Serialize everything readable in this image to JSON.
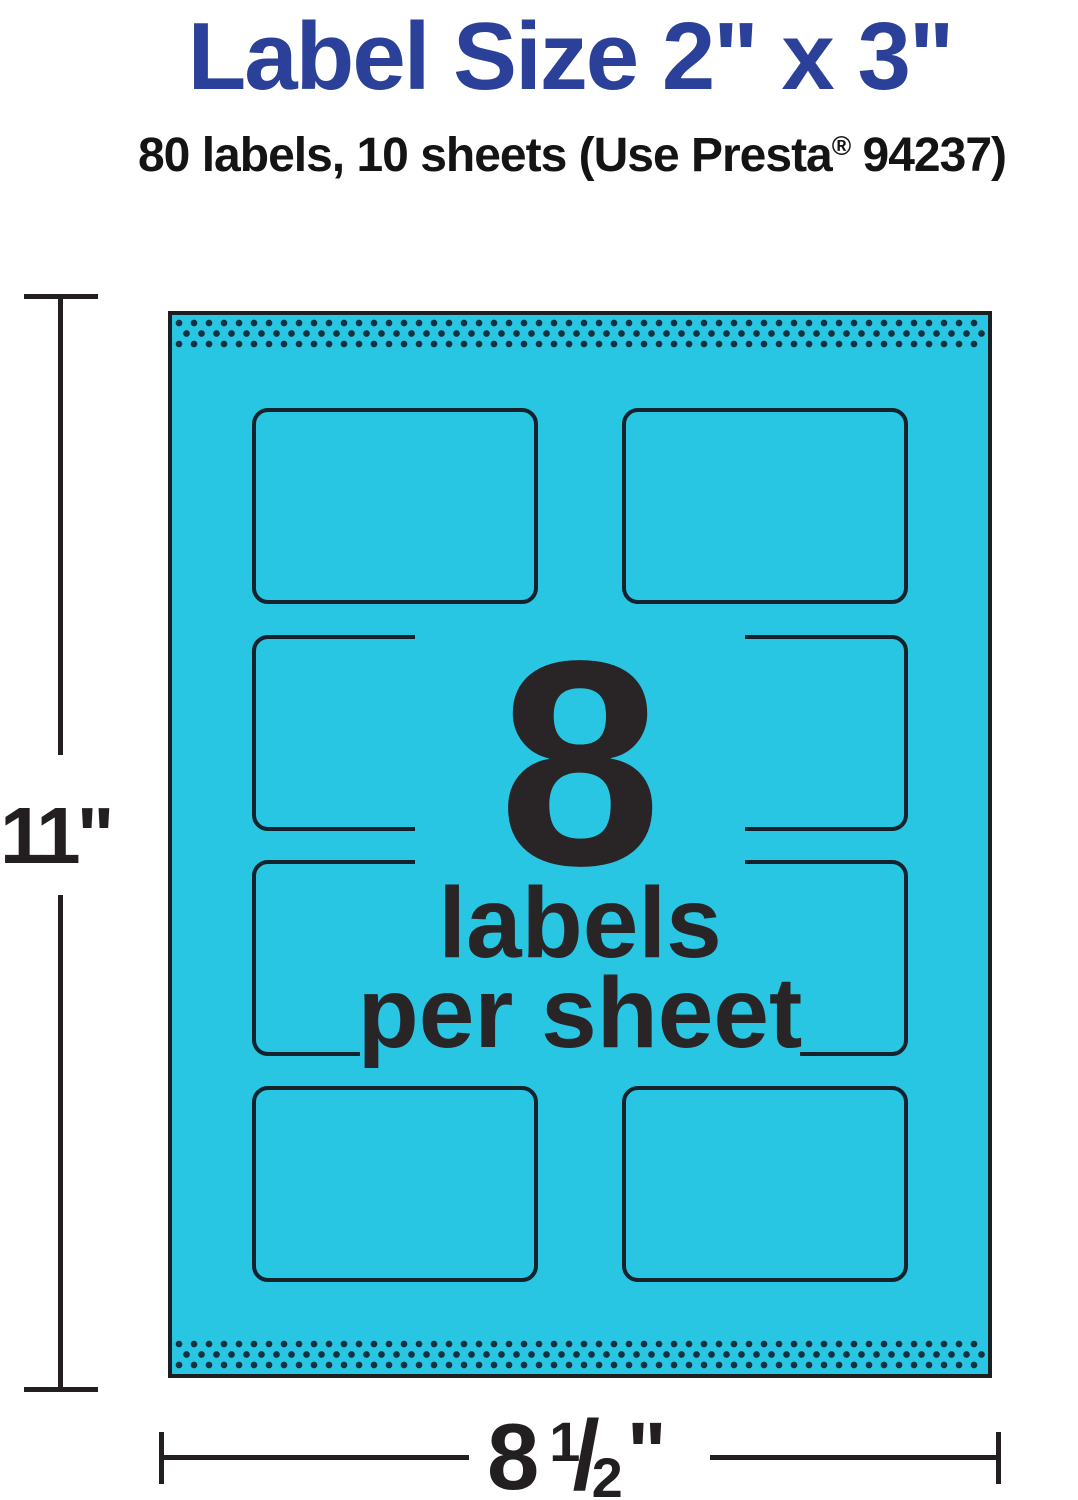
{
  "header": {
    "title": "Label Size 2\" x 3\"",
    "subtitle_pre": "80 labels, 10 sheets (Use Presta",
    "registered_mark": "®",
    "subtitle_post": " 94237)"
  },
  "callout": {
    "count": "8",
    "line2": "labels",
    "line3": "per sheet"
  },
  "sheet": {
    "labels_per_sheet": 8,
    "rows": 4,
    "columns": 2
  },
  "dimensions": {
    "height_label": "11\"",
    "width_whole": "8",
    "width_numerator": "1",
    "width_slash": "/",
    "width_denominator": "2",
    "width_unit": "\""
  },
  "colors": {
    "sheet_cyan": "#29C6E4",
    "title_blue": "#2B4199",
    "ink_black": "#231F20",
    "outline_dark": "#13222B",
    "dot_dark": "#123240"
  }
}
